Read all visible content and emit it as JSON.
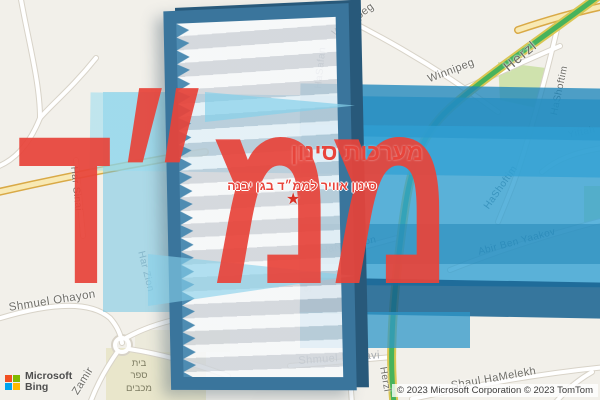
{
  "overlay": {
    "title": "מערכות סינון",
    "subtitle": "סינון אוויר לממ״ד בגן יבנה",
    "big_text": "ממ״ד",
    "star": "★",
    "accent_red": "#e8443b"
  },
  "map": {
    "streets": [
      {
        "label": "Winnipeg"
      },
      {
        "label": "Winnipeg"
      },
      {
        "label": "Herzl"
      },
      {
        "label": "HaShoftim"
      },
      {
        "label": "Yiftah"
      },
      {
        "label": "HaShoftim"
      },
      {
        "label": "Abir Ben Yaakov"
      },
      {
        "label": "HaNitsahon"
      },
      {
        "label": "HaSafan"
      },
      {
        "label": "Shabazi"
      },
      {
        "label": "HaRambam"
      },
      {
        "label": "Shmuel HaNavi"
      },
      {
        "label": "Har Sinai"
      },
      {
        "label": "Har Zion"
      },
      {
        "label": "Shmuel Ohayon"
      },
      {
        "label": "Zamir"
      },
      {
        "label": "Shaul HaMelekh"
      },
      {
        "label": "Herzl"
      }
    ],
    "school": {
      "lines": [
        "בית",
        "ספר",
        "מכבים"
      ]
    },
    "colors": {
      "road_green": "#47b35c",
      "road_yellow": "#f8e9b4",
      "park_green": "#cfe2ad",
      "band_blue": "#2f9fd2",
      "band_navy": "#15608f",
      "band_light": "#86d0ea"
    }
  },
  "attribution": {
    "brand_top": "Microsoft",
    "brand_bottom": "Bing",
    "copyright": "© 2023 Microsoft Corporation © 2023 TomTom"
  }
}
